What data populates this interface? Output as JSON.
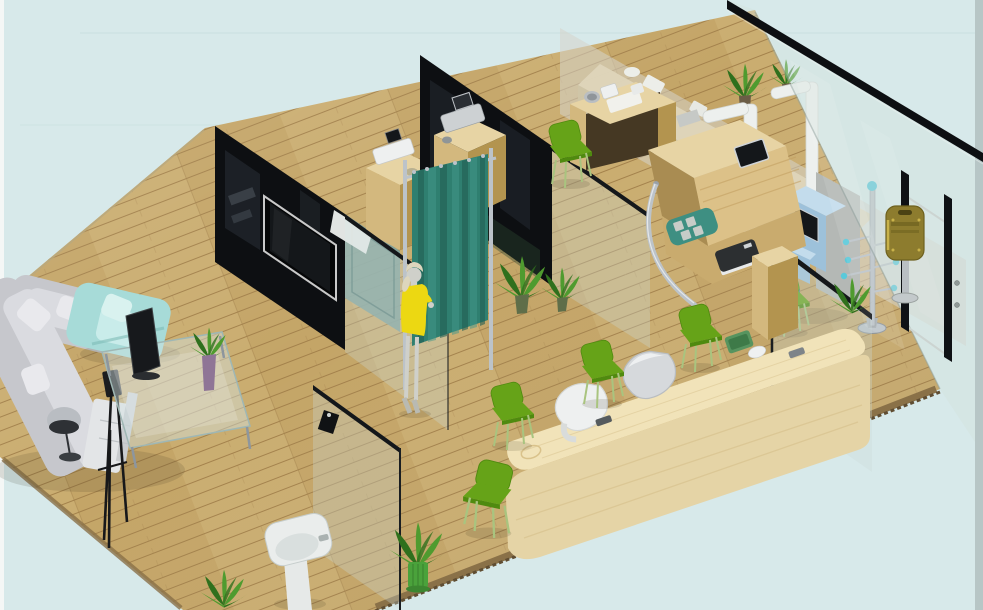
{
  "scene": {
    "type": "isometric-3d-interior-render",
    "setting": "health-screening-clinic-showroom",
    "camera": "high-angle-isometric",
    "canvas": {
      "width": 983,
      "height": 610
    }
  },
  "colors": {
    "bg": "#d7e9ea",
    "bgSeam": "#c5dddd",
    "edgeLeft": "#f4f7f6",
    "edgeRight": "#b7c6c6",
    "floor": "#c4a567",
    "floorLight": "#d0b478",
    "floorSeam": "#a3814b",
    "floorBorder": "#8a7148",
    "floorEdgeDark": "#5f4d32",
    "wallBlack": "#0d0f12",
    "reflGray": "#39424c",
    "glassFill": "rgba(203,219,214,0.32)",
    "glassPaneRight": "rgba(210,224,219,0.40)",
    "glassTopEdge": "#14171a",
    "glassStroke": "#8fa19d",
    "curtain": "#2f7f70",
    "curtainDark": "#235f53",
    "curtainLight": "#43988a",
    "chrome": "#bcc3c9",
    "chromeDark": "#8d969e",
    "woodTop": "#e7d4a4",
    "woodFront": "#d3b87e",
    "woodSide": "#b3944f",
    "woodGrain": "#c19e60",
    "woodKnee": "#453823",
    "counterTop": "#f1e3b9",
    "counterFront": "#e5d4a6",
    "counterGrain": "#d8c28e",
    "deviceWhite": "#eef0f0",
    "deviceGray": "#cdd1d3",
    "screenDark": "#14171a",
    "chairGreen": "#66a318",
    "chairGreenDark": "#4f8a0f",
    "chairLeg": "#a9c47f",
    "sofaGray": "#c6c7cc",
    "sofaLight": "#dadbe0",
    "pillowWhite": "#e9e9ed",
    "tealChair": "#a7dbd8",
    "tealChairLight": "#c9ecea",
    "skin": "#cfd0ca",
    "hair": "#ddd6bd",
    "dress": "#ecd812",
    "kioskBlue": "#9dc1da",
    "kioskBlueLight": "#c3dcec",
    "panelGray": "#b4b8b5",
    "olive": "#8d7c2e",
    "oliveDark": "#6e611f",
    "oliveLight": "#c9b24a",
    "blueKnob": "#5ac9da",
    "plantGreen": "#4f9b2f",
    "plantDark": "#2f701d",
    "potGreen": "#4aa23b",
    "potPurple": "#8f7596",
    "standWhite": "#edf0ee",
    "matTeal": "#3e8f82",
    "matSquare": "#c7ccc8",
    "scaleDark": "#2c2f31",
    "sinkWhite": "#eaedec",
    "sinkInner": "#d9dfde",
    "backPanel": "rgba(213,211,203,0.55)",
    "shadow": "rgba(60,50,30,0.14)",
    "tvFrame": "#c9c9c9"
  },
  "objects": {
    "lounge": [
      "l-shaped-sofa-gray",
      "armchair-teal",
      "glass-coffee-table",
      "laptop-screen",
      "plant-purple-vase",
      "floor-lamp",
      "side-cabinet-white",
      "easel-tripod-black"
    ],
    "exam_area": [
      "partition-wall-black-with-tv",
      "wall-mounted-tv",
      "teal-back-cabinet",
      "glass-partitions",
      "privacy-curtain-teal",
      "equipment-cabinet-1",
      "device-white-ecg",
      "equipment-cabinet-2",
      "device-gray-ecg",
      "white-exam-desk",
      "woman-yellow-dress"
    ],
    "measurement_area": [
      "blood-pressure-desk",
      "blood-pressure-monitor",
      "sloped-counter-with-tablet",
      "embedded-tablet",
      "chrome-handrail",
      "footprint-mat-teal",
      "weighing-scale-dark",
      "wooden-cabinet",
      "height-measure-stands-white"
    ],
    "back_office": [
      "back-counter-beige",
      "counter-devices-white",
      "potted-plants"
    ],
    "right_wall": [
      "glass-curtain-wall",
      "glass-door",
      "door-frame-bars-black",
      "suggestion-box-olive",
      "coat-stand-blue-knobs",
      "self-service-kiosk-blue"
    ],
    "reception": [
      "reception-counter-wood",
      "terminal-kiosk-white",
      "terminal-kiosk-silver",
      "green-tray",
      "computer-mouse",
      "card-slot-dark"
    ],
    "misc": [
      "pedestal-sink",
      "wood-plank-floor",
      "potted-plants-front"
    ]
  },
  "counts": {
    "green_chairs": 6,
    "potted_plants": 8,
    "glass_partitions": 6
  }
}
